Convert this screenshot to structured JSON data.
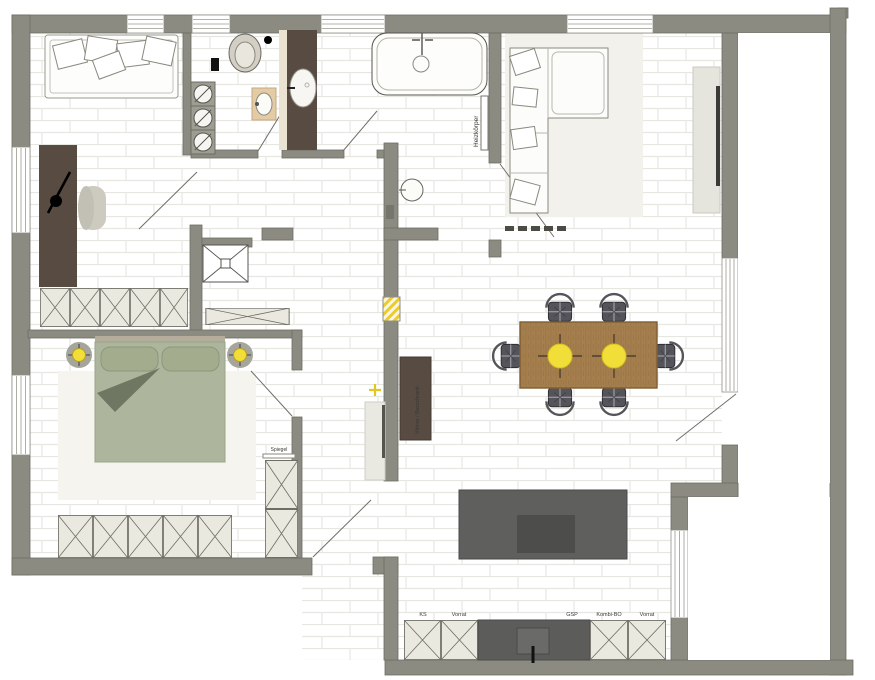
{
  "labels": {
    "heizkoerper": "Heizkörper",
    "vitrine": "Vitrine / Barschrank",
    "spiegel": "Spiegel",
    "kitchen": {
      "ks": "KS",
      "vorrat1": "Vorrat",
      "gsp": "GSP",
      "kombi": "Kombi-BO",
      "vorrat2": "Vorrat"
    }
  },
  "colors": {
    "wall": "#8C8B81",
    "wall_edge": "#6E6D64",
    "floor_joint": "#E7E7E2",
    "dark_wood": "#574B42",
    "beige": "#E3CBA6",
    "bed_green": "#ADB59C",
    "throw_green": "#6F7762",
    "accent_yellow": "#F2DE39",
    "table_wood": "#A57E4E",
    "island_gray": "#5F5F5D",
    "cabinet_fill": "#E9E9E0",
    "tv_black": "#3A3A36"
  }
}
